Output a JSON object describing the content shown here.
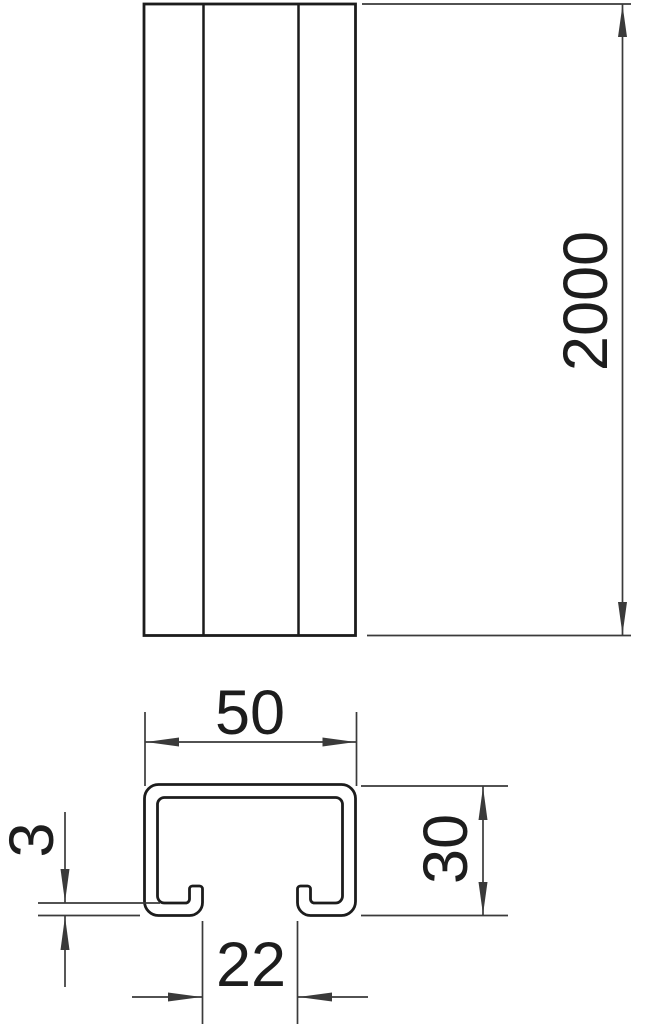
{
  "dimensions": {
    "rail_length": "2000",
    "profile_width": "50",
    "profile_height": "30",
    "slot_opening": "22",
    "material_thickness": "3"
  },
  "colors": {
    "object_line": "#1c1c1c",
    "dimension_line": "#3a3a3a",
    "background": "#ffffff"
  }
}
